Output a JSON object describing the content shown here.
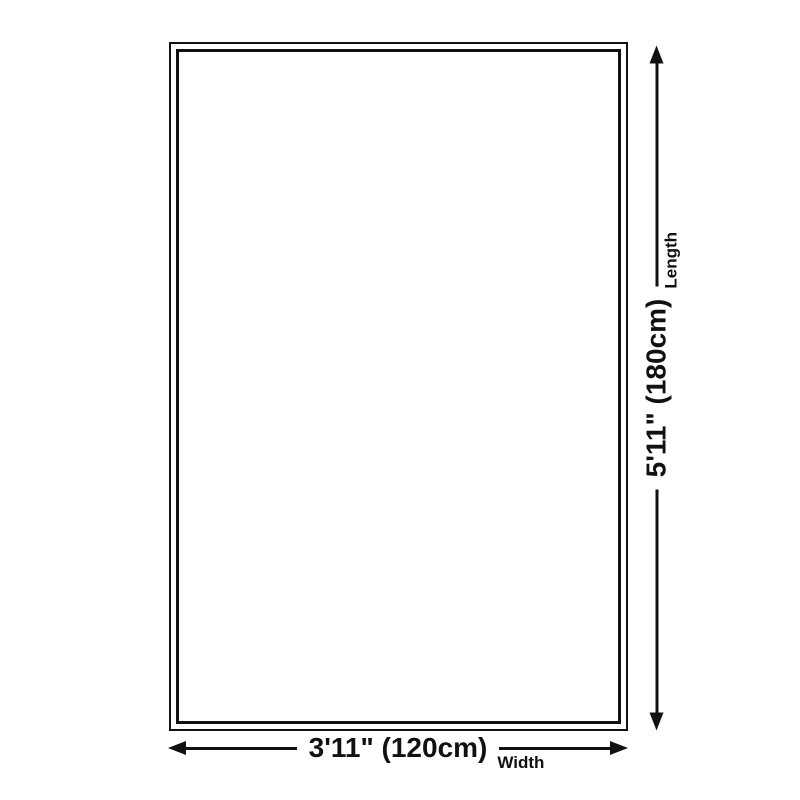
{
  "theme": {
    "background": "#ffffff",
    "line_color": "#111111"
  },
  "diagram": {
    "width_dimension": {
      "value": "3'11\" (120cm)",
      "label": "Width"
    },
    "length_dimension": {
      "value": "5'11\" (180cm)",
      "label": "Length"
    }
  }
}
